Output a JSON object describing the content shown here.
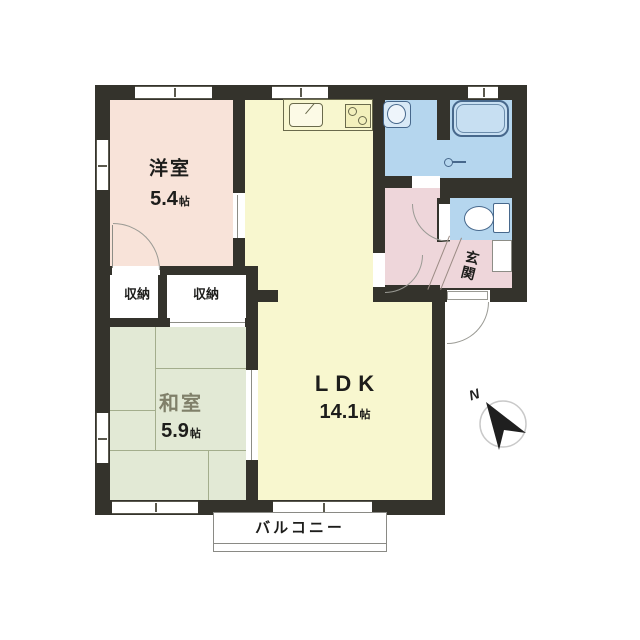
{
  "floor_plan": {
    "rooms": {
      "western": {
        "label": "洋室",
        "area_value": "5.4",
        "area_unit": "帖"
      },
      "japanese": {
        "label": "和室",
        "area_value": "5.9",
        "area_unit": "帖"
      },
      "ldk": {
        "label": "LDK",
        "area_value": "14.1",
        "area_unit": "帖"
      },
      "closet_left": {
        "label": "収納"
      },
      "closet_right": {
        "label": "収納"
      },
      "entrance": {
        "label": "玄関"
      },
      "balcony": {
        "label": "バルコニー"
      }
    },
    "compass": {
      "north_label": "N"
    },
    "colors": {
      "wall": "#34332c",
      "western": "#f8e3d9",
      "japanese": "#e2e9d5",
      "ldk": "#f8f7cf",
      "wet": "#b5d6ee",
      "tub": "#c7dff2",
      "hall": "#eed6da",
      "tatami_line": "#a3ad8c"
    }
  }
}
